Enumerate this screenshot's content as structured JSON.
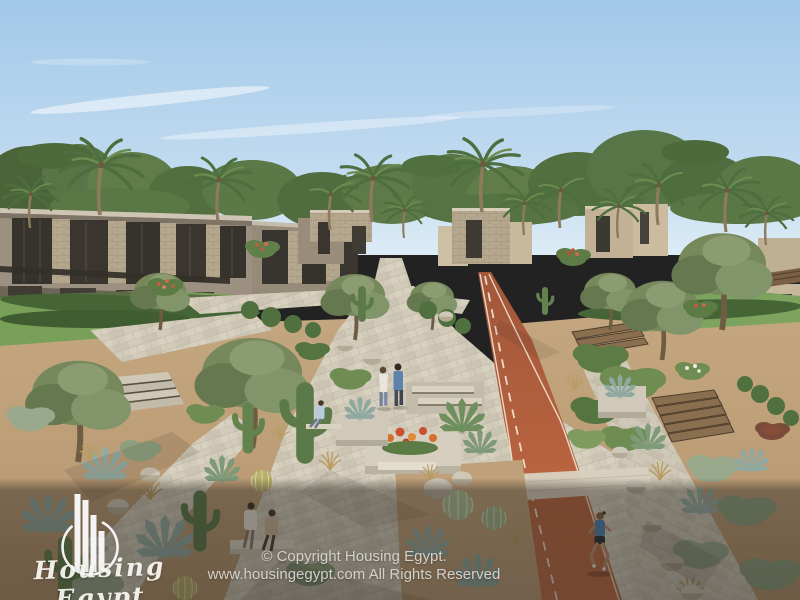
{
  "image": {
    "description": "Aerial daytime architectural render of a residential community: modern stone townhouses and villas among palm trees, desert-landscaped garden walkways with cacti and agaves, stone-paved plazas with people walking and sitting, and a terracotta running track with a female jogger."
  },
  "watermark": {
    "brand": "Housing Egypt",
    "logo_icon": "bar-chart-building-circle-logo"
  },
  "footer": {
    "copyright_line1": "© Copyright Housing Egypt.",
    "copyright_line2": "www.housingegypt.com All Rights Reserved"
  },
  "palette": {
    "sky_top": "#a6cbe9",
    "sky_horizon": "#dcebf5",
    "foliage_dark": "#4e6b3c",
    "foliage_mid": "#6d8a52",
    "lawn": "#7ba05c",
    "pavement": "#d2cbba",
    "running_track": "#b85f3d",
    "track_line": "#f2e9d9",
    "building_taupe": "#9c9080",
    "building_stone": "#bfae92",
    "window_dark": "#36322c",
    "sand": "#c6a87f",
    "bottom_overlay": "rgba(33,29,25,0.45)",
    "watermark_text": "#f7f5f1",
    "copyright_text": "#d9d6d1"
  }
}
